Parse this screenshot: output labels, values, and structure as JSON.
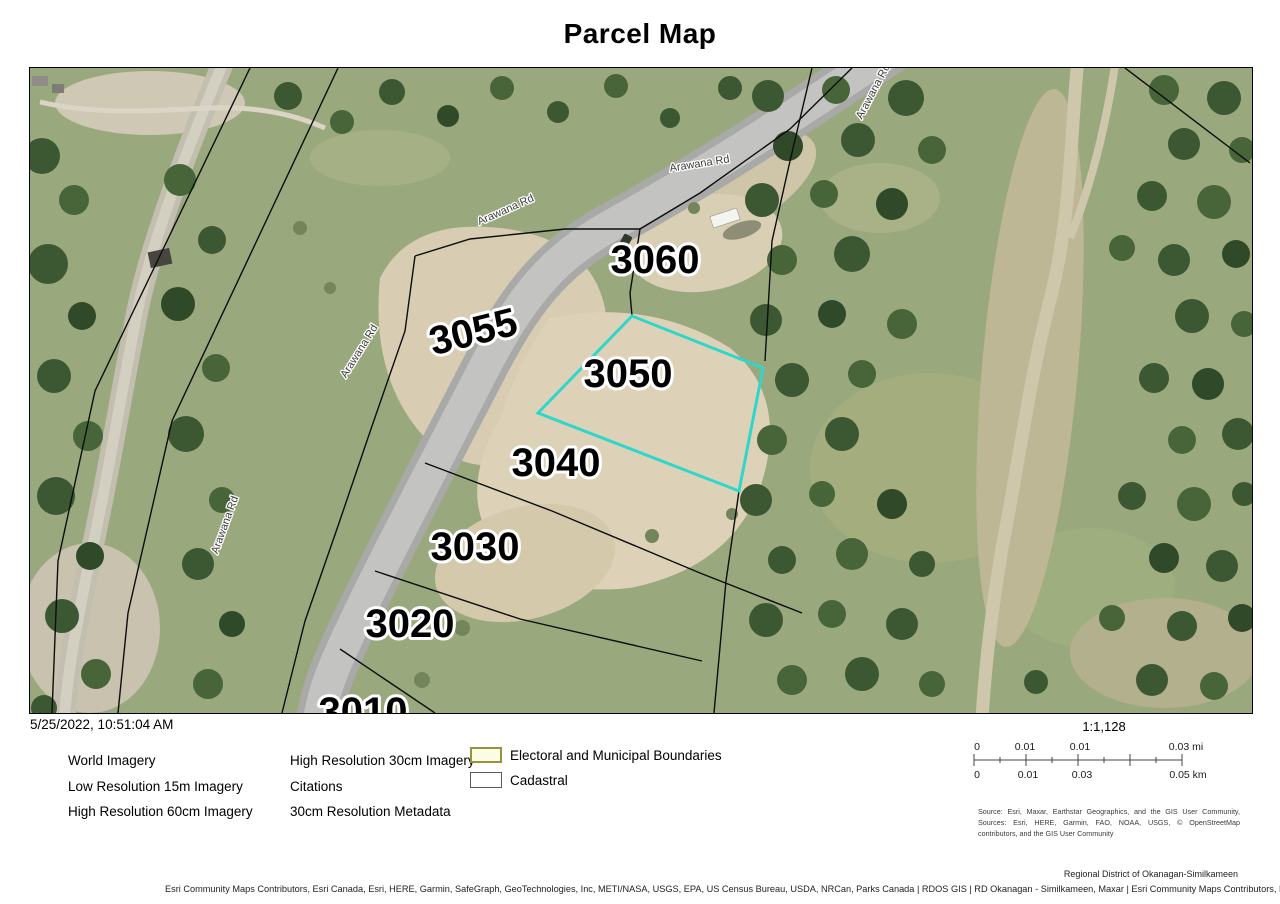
{
  "title": "Parcel Map",
  "meta": {
    "datetime": "5/25/2022, 10:51:04 AM"
  },
  "map": {
    "parcels": [
      "3060",
      "3055",
      "3050",
      "3040",
      "3030",
      "3020",
      "3010"
    ],
    "road_label": "Arawana Rd",
    "highlight_parcel": "3050",
    "highlight_color": "#2fd7cb"
  },
  "legend": {
    "col1": [
      "World Imagery",
      "Low Resolution 15m Imagery",
      "High Resolution 60cm Imagery"
    ],
    "col2": [
      "High Resolution 30cm Imagery",
      "Citations",
      "30cm Resolution Metadata"
    ],
    "boundary_items": [
      {
        "label": "Electoral and Municipal Boundaries",
        "fill": "#fcfce4",
        "border": "#94943f"
      },
      {
        "label": "Cadastral",
        "fill": "#ffffff",
        "border": "#595959"
      }
    ]
  },
  "scale": {
    "ratio": "1:1,128",
    "mi_labels": [
      "0",
      "0.01",
      "0.01",
      "0.03 mi"
    ],
    "km_labels": [
      "0",
      "0.01",
      "0.03",
      "0.05 km"
    ]
  },
  "source_text": "Source: Esri, Maxar, Earthstar Geographics, and the GIS User Community, Sources: Esri, HERE, Garmin, FAO, NOAA, USGS, © OpenStreetMap contributors, and the GIS User Community",
  "credits": {
    "district": "Regional District of Okanagan-Similkameen",
    "attribution": "Esri Community Maps Contributors, Esri Canada, Esri, HERE, Garmin, SafeGraph, GeoTechnologies, Inc, METI/NASA, USGS, EPA, US Census Bureau, USDA, NRCan, Parks Canada | RDOS GIS | RD Okanagan - Similkameen, Maxar | Esri Community Maps Contributors, Esri Canada, Esri, HERE, Garmin,"
  }
}
